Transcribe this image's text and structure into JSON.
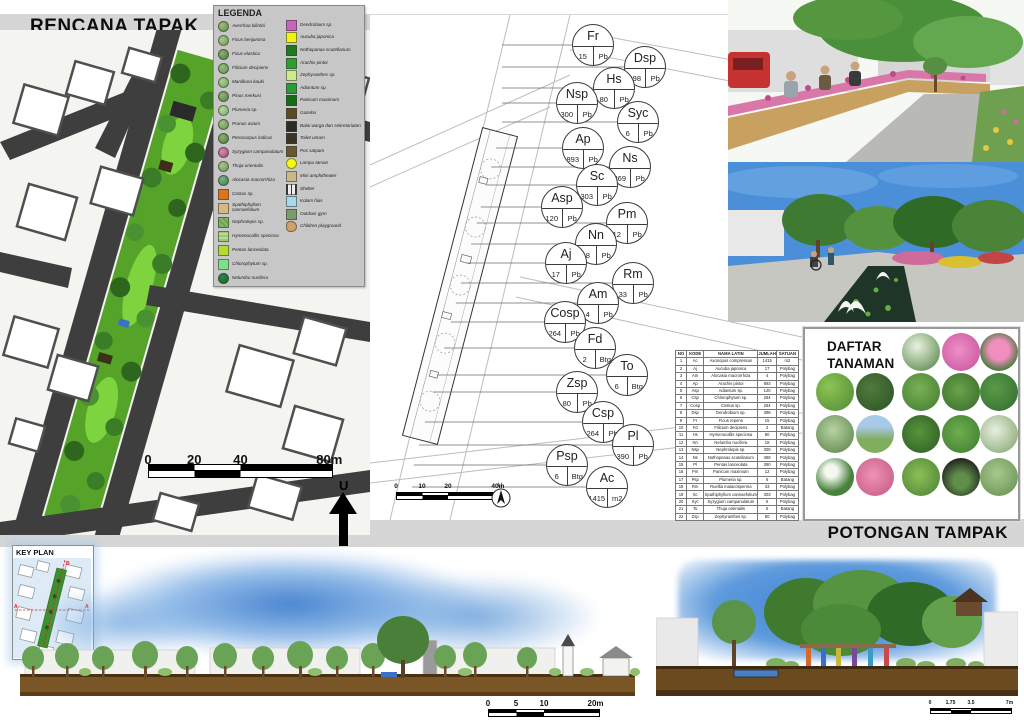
{
  "titles": {
    "site_plan": "RENCANA TAPAK",
    "planting_plan": "RENCANA PENANAMAN",
    "sections": "POTONGAN TAMPAK",
    "key_plan": "KEY PLAN",
    "legend": "LEGENDA",
    "plant_list_line1": "DAFTAR",
    "plant_list_line2": "TANAMAN"
  },
  "north_label": "U",
  "legend": {
    "plants": [
      {
        "name": "Averrhoa bilimbi",
        "bg": "radial-gradient(circle at 35% 35%, #9cbd7e, #5f8a49)",
        "r": "50%"
      },
      {
        "name": "Ficus benjamina",
        "bg": "radial-gradient(circle at 35% 35%, #a9c98b, #6d9a55)",
        "r": "50%"
      },
      {
        "name": "Ficus elastica",
        "bg": "radial-gradient(circle at 35% 35%, #8fb071, #4f7a3e)",
        "r": "50%"
      },
      {
        "name": "Filicium decipiens",
        "bg": "radial-gradient(circle at 35% 35%, #9bbf7d, #5b8f46)",
        "r": "50%"
      },
      {
        "name": "Manilkara kauki",
        "bg": "radial-gradient(circle at 35% 35%, #b2cf94, #6fa055)",
        "r": "50%"
      },
      {
        "name": "Pinus merkusi",
        "bg": "radial-gradient(circle at 35% 35%, #93b375, #567f42)",
        "r": "50%"
      },
      {
        "name": "Plumeria sp.",
        "bg": "radial-gradient(circle at 35% 35%, #bcd8a0, #7ba864)",
        "r": "50%"
      },
      {
        "name": "Prunus avium",
        "bg": "radial-gradient(circle at 35% 35%, #a3c285, #628d4c)",
        "r": "50%"
      },
      {
        "name": "Pterocarpus indicus",
        "bg": "radial-gradient(circle at 35% 35%, #8eb070, #4e793d)",
        "r": "50%"
      },
      {
        "name": "Syzygium campanulatum",
        "bg": "radial-gradient(circle at 35% 35%, #d98ab0, #a04a72)",
        "r": "50%"
      },
      {
        "name": "Thuja orientalis",
        "bg": "radial-gradient(circle at 35% 35%, #aac88c, #689353)",
        "r": "50%"
      },
      {
        "name": "Alocasia macrorrhiza",
        "bg": "radial-gradient(circle at 35% 35%, #7fb089, #3f7a52)",
        "r": "50%"
      },
      {
        "name": "Costus sp.",
        "bg": "#e07416",
        "r": "0"
      },
      {
        "name": "Spathiphyllum cannaefolium",
        "bg": "#d5bc7e",
        "r": "0"
      },
      {
        "name": "Nephrolepis sp.",
        "bg": "repeating-linear-gradient(45deg,#6fa04f 0 2px,#87b868 2px 4px)",
        "r": "0"
      },
      {
        "name": "Hymenocallis speciosa",
        "bg": "repeating-linear-gradient(0deg,#9cc87c 0 2px,#b4dc96 2px 4px)",
        "r": "0"
      },
      {
        "name": "Pentas lanceolata",
        "bg": "#b8d832",
        "r": "0"
      },
      {
        "name": "Chlorophytum sp.",
        "bg": "#7ee08a",
        "r": "0"
      },
      {
        "name": "Nelumbo nucifera",
        "bg": "radial-gradient(circle at 35% 35%, #2a8a42, #15632a)",
        "r": "50%"
      }
    ],
    "features": [
      {
        "name": "Dendrobium sp.",
        "bg": "#c964bc",
        "r": "0"
      },
      {
        "name": "Aucuba japonica",
        "bg": "#f2f20e",
        "r": "0"
      },
      {
        "name": "Nothopanax scutellarium",
        "bg": "#1d7a21",
        "r": "0"
      },
      {
        "name": "Arachis pintoi",
        "bg": "#2f9e2f",
        "r": "0"
      },
      {
        "name": "Zephyranthes sp.",
        "bg": "#cdeb8a",
        "r": "0"
      },
      {
        "name": "Adiantum sp.",
        "bg": "#2c9a35",
        "r": "0"
      },
      {
        "name": "Panicum maximum",
        "bg": "#156b15",
        "r": "0"
      },
      {
        "name": "Gazebo",
        "bg": "#5c4a22",
        "r": "0"
      },
      {
        "name": "Balai warga dan sekretariatan",
        "bg": "#2b2b25",
        "r": "0"
      },
      {
        "name": "Toilet umum",
        "bg": "#3a3326",
        "r": "0"
      },
      {
        "name": "Pos satpam",
        "bg": "#6b5630",
        "r": "0"
      },
      {
        "name": "Lampu taman",
        "bg": "#f7f711",
        "r": "50%"
      },
      {
        "name": "Mini amphitheater",
        "bg": "#c9b98a",
        "r": "0"
      },
      {
        "name": "Shelter",
        "bg": "repeating-linear-gradient(90deg,#333 0 1px,#eee 1px 4px)",
        "r": "0"
      },
      {
        "name": "Kolam hias",
        "bg": "#a6d9ea",
        "r": "0"
      },
      {
        "name": "Outdoor gym",
        "bg": "#7d9c6b",
        "r": "0"
      },
      {
        "name": "Children playground",
        "bg": "#cfa06a",
        "r": "40% 60% 55% 45%"
      }
    ]
  },
  "planting": {
    "labels": [
      {
        "code": "Fr",
        "qty": "15",
        "unit": "Pb",
        "left": 202,
        "top": 9
      },
      {
        "code": "Dsp",
        "qty": "398",
        "unit": "Pb",
        "left": 254,
        "top": 31
      },
      {
        "code": "Hs",
        "qty": "80",
        "unit": "Pb",
        "left": 223,
        "top": 52
      },
      {
        "code": "Nsp",
        "qty": "300",
        "unit": "Pb",
        "left": 186,
        "top": 67
      },
      {
        "code": "Syc",
        "qty": "6",
        "unit": "Pb",
        "left": 247,
        "top": 86
      },
      {
        "code": "Ap",
        "qty": "893",
        "unit": "Pb",
        "left": 192,
        "top": 112
      },
      {
        "code": "Ns",
        "qty": "369",
        "unit": "Pb",
        "left": 239,
        "top": 131
      },
      {
        "code": "Sc",
        "qty": "303",
        "unit": "Pb",
        "left": 206,
        "top": 149
      },
      {
        "code": "Asp",
        "qty": "120",
        "unit": "Pb",
        "left": 171,
        "top": 171
      },
      {
        "code": "Pm",
        "qty": "12",
        "unit": "Pb",
        "left": 236,
        "top": 187
      },
      {
        "code": "Nn",
        "qty": "18",
        "unit": "Pb",
        "left": 205,
        "top": 208
      },
      {
        "code": "Aj",
        "qty": "17",
        "unit": "Pb",
        "left": 175,
        "top": 227
      },
      {
        "code": "Rm",
        "qty": "33",
        "unit": "Pb",
        "left": 242,
        "top": 247
      },
      {
        "code": "Am",
        "qty": "4",
        "unit": "Pb",
        "left": 207,
        "top": 267
      },
      {
        "code": "Cosp",
        "qty": "264",
        "unit": "Pb",
        "left": 174,
        "top": 286
      },
      {
        "code": "Fd",
        "qty": "2",
        "unit": "Btg",
        "left": 204,
        "top": 312
      },
      {
        "code": "To",
        "qty": "6",
        "unit": "Btg",
        "left": 236,
        "top": 339
      },
      {
        "code": "Zsp",
        "qty": "80",
        "unit": "Pb",
        "left": 186,
        "top": 356
      },
      {
        "code": "Csp",
        "qty": "264",
        "unit": "Pb",
        "left": 212,
        "top": 386
      },
      {
        "code": "Pl",
        "qty": "390",
        "unit": "Pb",
        "left": 242,
        "top": 409
      },
      {
        "code": "Psp",
        "qty": "6",
        "unit": "Btg",
        "left": 176,
        "top": 429
      },
      {
        "code": "Ac",
        "qty": "1415",
        "unit": "m2",
        "left": 216,
        "top": 451
      }
    ]
  },
  "plant_table": {
    "headers": [
      "NO",
      "KODE",
      "NAMA LATIN",
      "JUMLAH",
      "SATUAN"
    ],
    "rows": [
      [
        "1",
        "Ac",
        "Axonopus compressus",
        "1415",
        "m2"
      ],
      [
        "2",
        "Aj",
        "Aucuba japonica",
        "17",
        "Polybag"
      ],
      [
        "3",
        "Am",
        "Alocasia macrorrhiza",
        "4",
        "Polybag"
      ],
      [
        "4",
        "Ap",
        "Arachis pintoi",
        "893",
        "Polybag"
      ],
      [
        "5",
        "Asp",
        "Adiantum sp.",
        "120",
        "Polybag"
      ],
      [
        "6",
        "Csp",
        "Chlorophytum sp.",
        "264",
        "Polybag"
      ],
      [
        "7",
        "Cosp",
        "Costus sp.",
        "264",
        "Polybag"
      ],
      [
        "8",
        "Dsp",
        "Dendrobium sp.",
        "398",
        "Polybag"
      ],
      [
        "9",
        "Fr",
        "Ficus repens",
        "15",
        "Polybag"
      ],
      [
        "10",
        "Fd",
        "Filicium decipiens",
        "2",
        "Batang"
      ],
      [
        "11",
        "Hs",
        "Hymenocallis speciosa",
        "80",
        "Polybag"
      ],
      [
        "12",
        "Nn",
        "Nelumbo nucifera",
        "18",
        "Polybag"
      ],
      [
        "13",
        "Nsp",
        "Nephrolepis sp.",
        "300",
        "Polybag"
      ],
      [
        "14",
        "Ns",
        "Nothopanax scutellarium",
        "369",
        "Polybag"
      ],
      [
        "15",
        "Pl",
        "Pentas lanceolata",
        "390",
        "Polybag"
      ],
      [
        "16",
        "Pm",
        "Panicum maximum",
        "12",
        "Polybag"
      ],
      [
        "17",
        "Psp",
        "Plumeria sp.",
        "6",
        "Batang"
      ],
      [
        "18",
        "Rm",
        "Ruellia malacosperma",
        "33",
        "Polybag"
      ],
      [
        "19",
        "Sc",
        "Spathiphyllum cannaefolium",
        "303",
        "Polybag"
      ],
      [
        "20",
        "Syc",
        "Syzygium campanulatum",
        "6",
        "Polybag"
      ],
      [
        "21",
        "To",
        "Thuja orientalis",
        "6",
        "Batang"
      ],
      [
        "22",
        "Zsp",
        "Zephyranthes sp.",
        "80",
        "Polybag"
      ]
    ]
  },
  "plant_list": {
    "circles": [
      {
        "left": 97,
        "top": 4,
        "bg": "radial-gradient(circle at 40% 35%, #eaf2e2, #4a7d3a)"
      },
      {
        "left": 137,
        "top": 4,
        "bg": "radial-gradient(circle at 45% 45%, #ef8fc4, #c44f9e)"
      },
      {
        "left": 175,
        "top": 4,
        "bg": "radial-gradient(circle at 50% 45%, #f08ec0 35%, #3f7a33 75%)"
      },
      {
        "left": 11,
        "top": 44,
        "bg": "radial-gradient(circle at 35% 35%, #8cc455, #4f8a33)"
      },
      {
        "left": 51,
        "top": 44,
        "bg": "radial-gradient(circle at 40% 40%, #4f7a3c, #2c5226)"
      },
      {
        "left": 97,
        "top": 44,
        "bg": "radial-gradient(circle at 45% 40%, #7ab054, #3f7a30)"
      },
      {
        "left": 137,
        "top": 44,
        "bg": "radial-gradient(circle at 45% 45%, #6aa34a, #35682a)"
      },
      {
        "left": 175,
        "top": 44,
        "bg": "radial-gradient(circle at 40% 40%, #5c9a48, #2f6b30)"
      },
      {
        "left": 11,
        "top": 86,
        "bg": "radial-gradient(circle at 45% 40%, #b7d3a4, #567f42)"
      },
      {
        "left": 51,
        "top": 86,
        "bg": "linear-gradient(180deg, #a9c9e8 30%, #7fae5f 65%)"
      },
      {
        "left": 97,
        "top": 86,
        "bg": "radial-gradient(circle at 45% 45%, #57953a, #2b5a24)"
      },
      {
        "left": 137,
        "top": 86,
        "bg": "radial-gradient(circle at 45% 45%, #6fae4e, #3c7a30)"
      },
      {
        "left": 175,
        "top": 86,
        "bg": "radial-gradient(circle at 40% 40%, #e7efe0, #7fa06a)"
      },
      {
        "left": 11,
        "top": 129,
        "bg": "radial-gradient(circle at 40% 35%, #f4f8f0 18%, #48823c 60%)"
      },
      {
        "left": 51,
        "top": 129,
        "bg": "radial-gradient(circle at 45% 45%, #ef93b5, #c25580)"
      },
      {
        "left": 97,
        "top": 129,
        "bg": "radial-gradient(circle at 45% 45%, #8cc057, #497f33)"
      },
      {
        "left": 137,
        "top": 129,
        "bg": "radial-gradient(circle at 50% 60%, #5f8f4a 25%, #23271f 75%)"
      },
      {
        "left": 175,
        "top": 129,
        "bg": "radial-gradient(circle at 45% 40%, #a7c98e, #628d4c)"
      }
    ]
  },
  "scales": {
    "site": [
      {
        "t": "0",
        "p": "0%"
      },
      {
        "t": "20",
        "p": "25%"
      },
      {
        "t": "40",
        "p": "50%"
      },
      {
        "t": "80m",
        "p": "98%"
      }
    ],
    "planting": [
      {
        "t": "0",
        "p": "0%"
      },
      {
        "t": "10",
        "p": "25%"
      },
      {
        "t": "20",
        "p": "50%"
      },
      {
        "t": "40m",
        "p": "98%"
      }
    ],
    "secA": [
      {
        "t": "0",
        "p": "0%"
      },
      {
        "t": "5",
        "p": "25%"
      },
      {
        "t": "10",
        "p": "50%"
      },
      {
        "t": "20m",
        "p": "96%"
      }
    ],
    "secB": [
      {
        "t": "0",
        "p": "0%"
      },
      {
        "t": "1.75",
        "p": "25%"
      },
      {
        "t": "3.5",
        "p": "50%"
      },
      {
        "t": "7m",
        "p": "97%"
      }
    ]
  },
  "key_plan": {
    "label_a": "A",
    "label_b": "B"
  }
}
